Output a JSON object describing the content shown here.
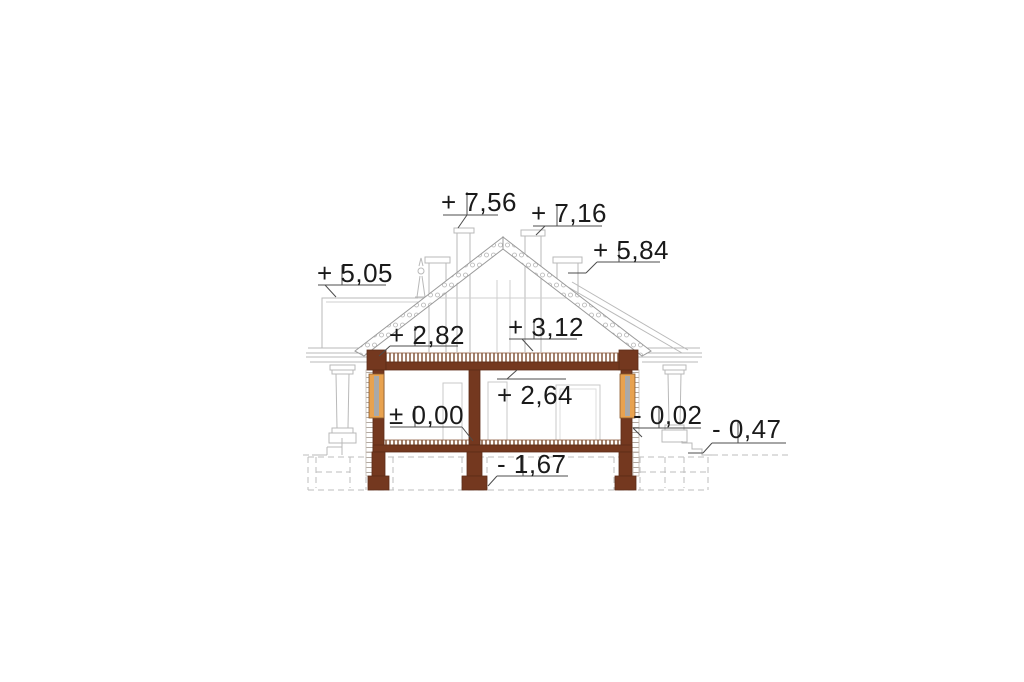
{
  "drawing": {
    "kind": "house-cross-section",
    "colors": {
      "cut_wall_brown": "#74381f",
      "window_frame_orange": "#e8a24f",
      "window_glass_gray": "#a9a9a9",
      "elevation_line_gray": "#b9b9b9",
      "marker_line_gray": "#4d4d4d",
      "text_black": "#1a1a1a",
      "background": "#ffffff"
    }
  },
  "markers": [
    {
      "name": "main-chimney-top",
      "label": "+ 7,56"
    },
    {
      "name": "second-chimney-top",
      "label": "+ 7,16"
    },
    {
      "name": "side-roof-chimney-top",
      "label": "+ 5,84"
    },
    {
      "name": "left-roof-ridge",
      "label": "+ 5,05"
    },
    {
      "name": "eaves-wall-plate",
      "label": "+ 2,82"
    },
    {
      "name": "attic-level",
      "label": "+ 3,12"
    },
    {
      "name": "ceiling-height",
      "label": "+ 2,64"
    },
    {
      "name": "ground-floor-zero",
      "label": "± 0,00"
    },
    {
      "name": "terrace-floor-level",
      "label": "- 0,02"
    },
    {
      "name": "grade-level",
      "label": "- 0,47"
    },
    {
      "name": "foundation-level",
      "label": "- 1,67"
    }
  ]
}
